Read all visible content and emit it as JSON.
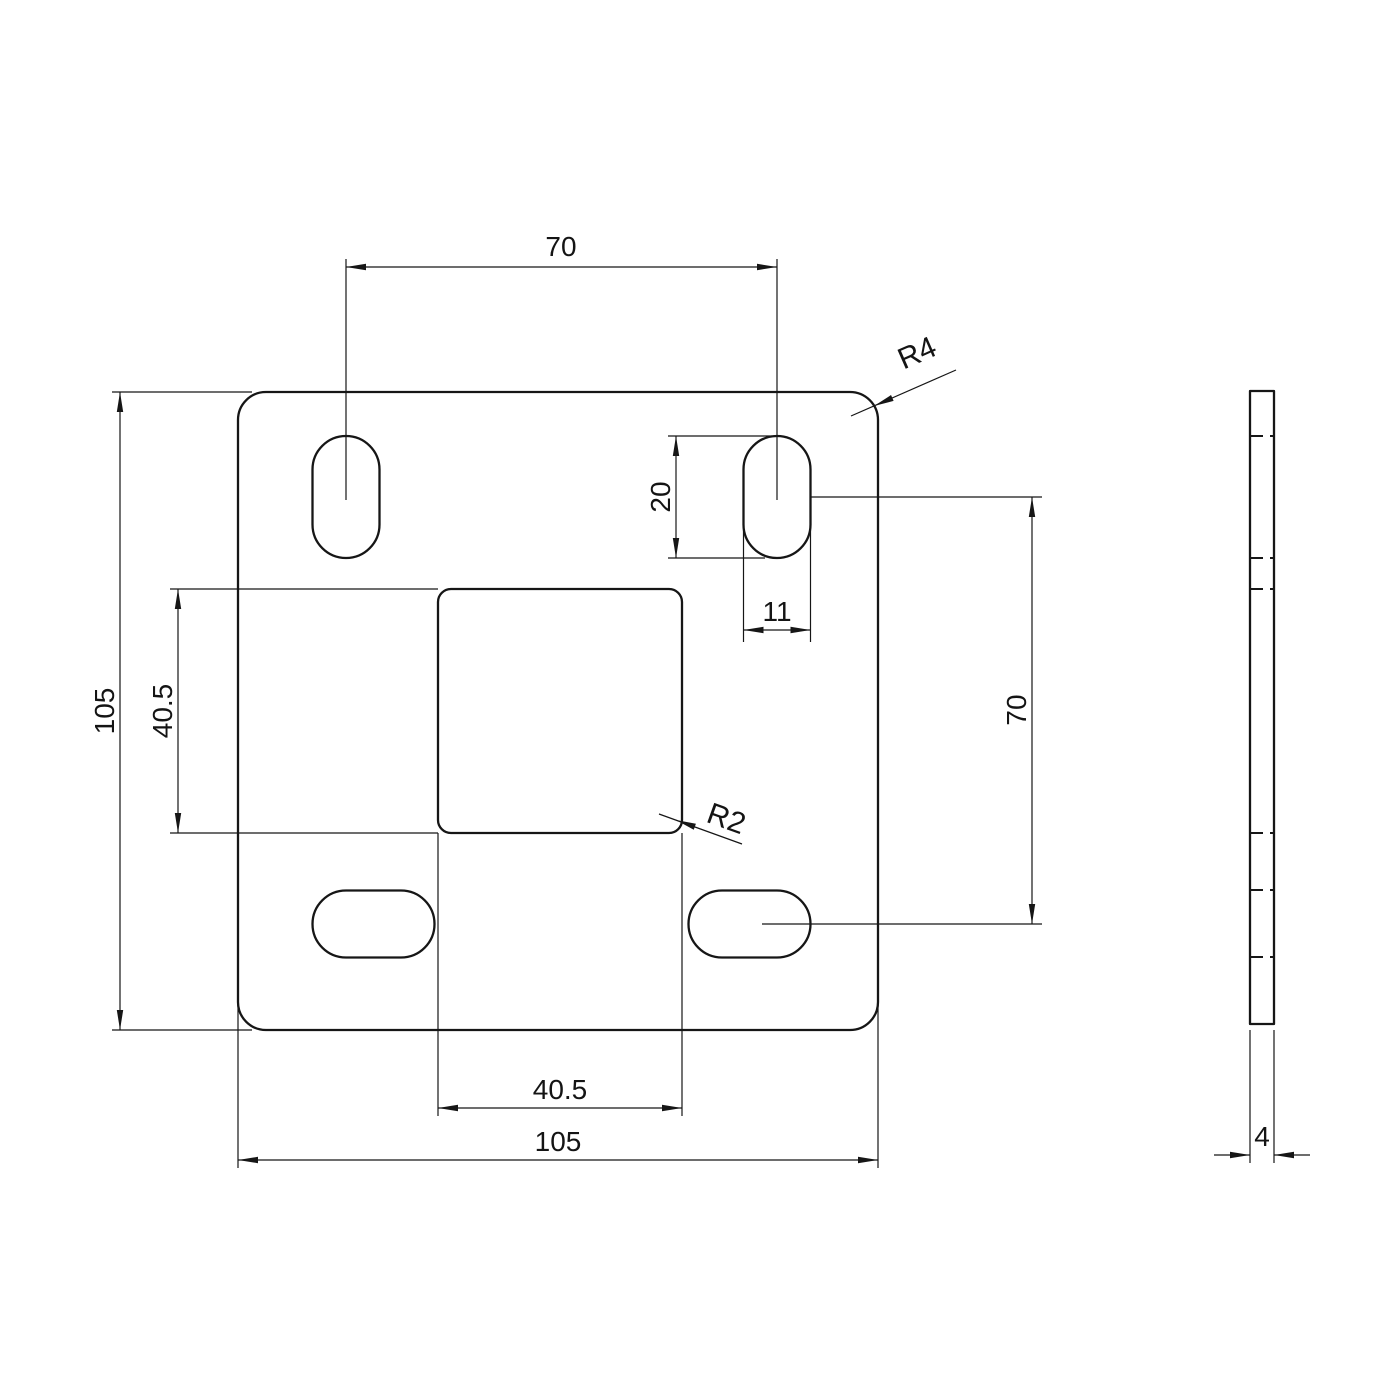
{
  "drawing": {
    "background_color": "#ffffff",
    "line_color": "#161616",
    "views": {
      "front_view": "plate front view",
      "side_view": "plate side view"
    },
    "labels": {
      "slot_spacing_top": "70",
      "plate_height": "105",
      "cutout_height": "40.5",
      "slot_length": "20",
      "slot_width": "11",
      "slot_spacing_right": "70",
      "cutout_width": "40.5",
      "plate_width": "105",
      "corner_radius": "R4",
      "cutout_corner_radius": "R2",
      "thickness": "4"
    }
  }
}
